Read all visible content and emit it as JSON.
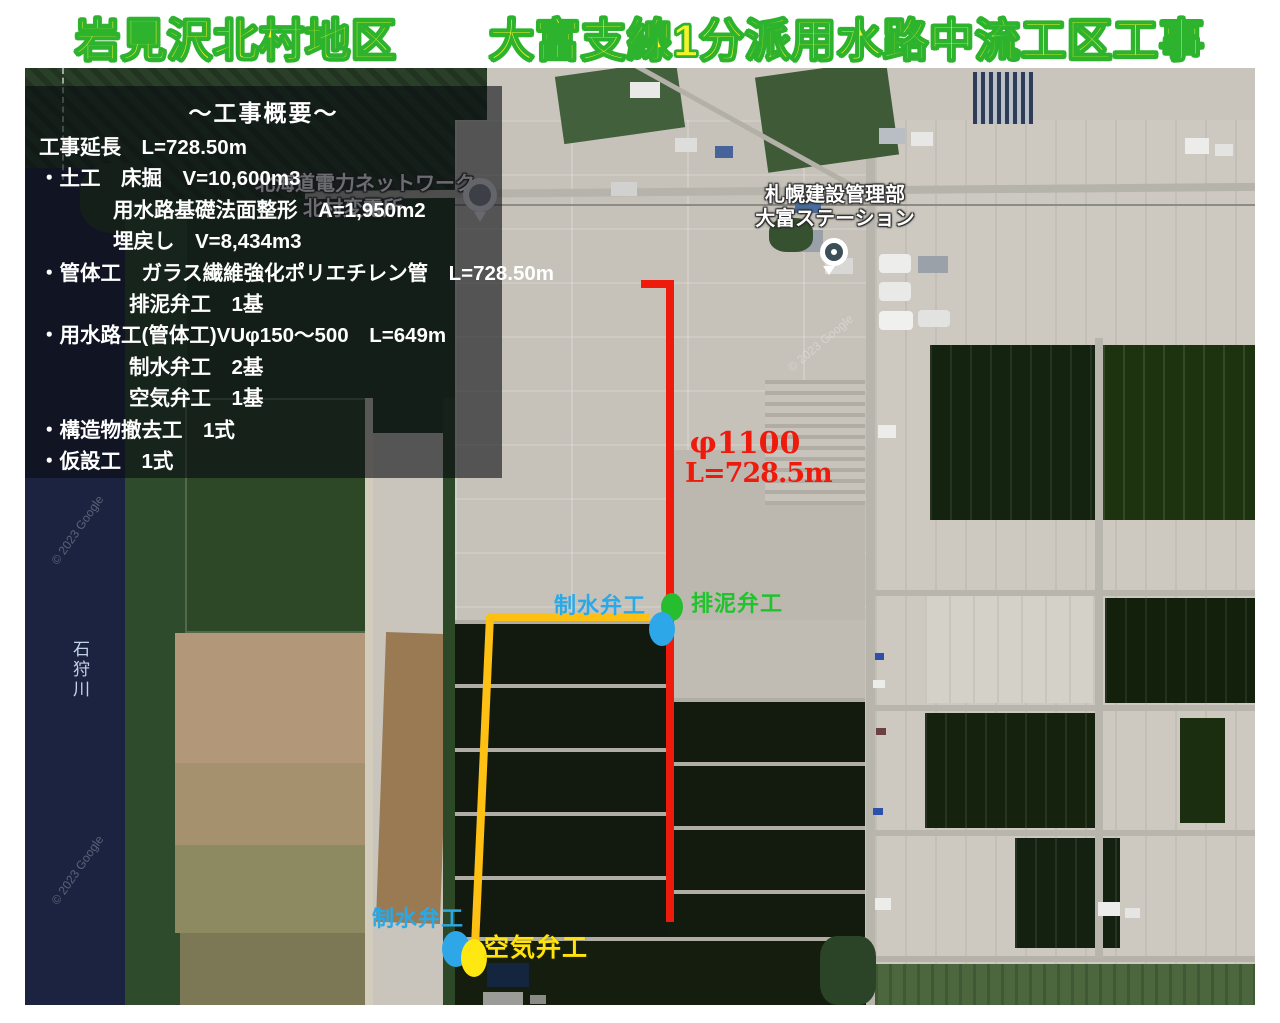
{
  "title": {
    "text": "岩見沢北村地区　　大富支線1分派用水路中流工区工事",
    "fill_color": "#f3f22c",
    "outline_color": "#2db32d"
  },
  "overview": {
    "heading": "～工事概要～",
    "lines": [
      {
        "text": "工事延長　L=728.50m"
      },
      {
        "text": "・土工　床掘　V=10,600m3"
      },
      {
        "text": "用水路基礎法面整形　A=1,950m2"
      },
      {
        "text": "埋戻し　V=8,434m3"
      },
      {
        "text": "・管体工　ガラス繊維強化ポリエチレン管　L=728.50m"
      },
      {
        "text": "排泥弁工　1基"
      },
      {
        "text": "・用水路工(管体工)VUφ150～500　L=649m"
      },
      {
        "text": "制水弁工　2基"
      },
      {
        "text": "空気弁工　1基"
      },
      {
        "text": "・構造物撤去工　1式"
      },
      {
        "text": "・仮設工　1式"
      }
    ]
  },
  "pipeline": {
    "diameter_label": "φ1100",
    "length_label": "L=728.5m",
    "main_route_color": "#ee1a0c",
    "branch_route_color": "#fdc013"
  },
  "valves": {
    "mid_control_valve_label": "制水弁工",
    "drain_valve_label": "排泥弁工",
    "bottom_control_valve_label": "制水弁工",
    "air_valve_label": "空気弁工",
    "control_valve_color": "#2aa9e8",
    "drain_valve_color": "#26bd2f",
    "air_valve_color": "#ffe30a"
  },
  "places": {
    "power_company_line1": "北海道電力ネットワーク",
    "power_company_line2": "北村変電所",
    "station_line1": "札幌建設管理部",
    "station_line2": "大富ステーション",
    "river_name": "石狩川",
    "watermark": "© 2023 Google"
  }
}
